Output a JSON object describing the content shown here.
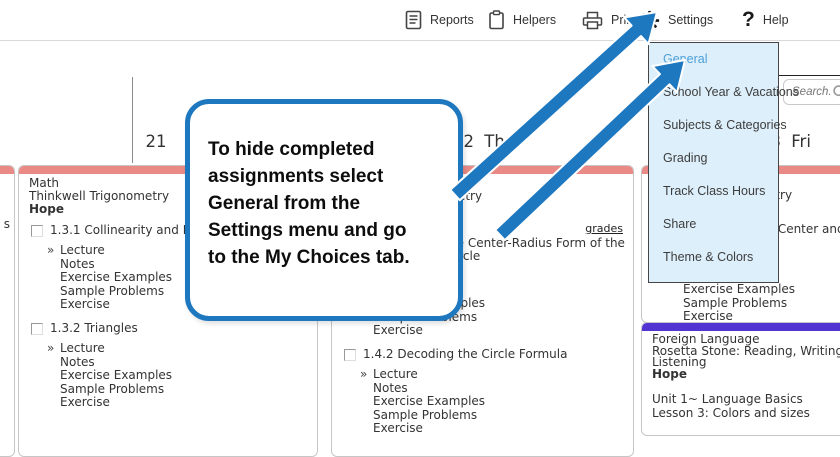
{
  "toolbar": {
    "items": [
      {
        "id": "reports",
        "label": "Reports",
        "icon": "reports-icon"
      },
      {
        "id": "helpers",
        "label": "Helpers",
        "icon": "helpers-icon"
      },
      {
        "id": "print",
        "label": "Print",
        "icon": "print-icon"
      },
      {
        "id": "settings",
        "label": "Settings",
        "icon": "settings-gear-icon"
      },
      {
        "id": "help",
        "label": "Help",
        "icon": "help-icon"
      }
    ]
  },
  "search": {
    "placeholder": "Search."
  },
  "settings_menu": {
    "items": [
      {
        "label": "General",
        "active": true
      },
      {
        "label": "School Year & Vacations",
        "active": false
      },
      {
        "label": "Subjects & Categories",
        "active": false
      },
      {
        "label": "Grading",
        "active": false
      },
      {
        "label": "Track Class Hours",
        "active": false
      },
      {
        "label": "Share",
        "active": false
      },
      {
        "label": "Theme & Colors",
        "active": false
      }
    ]
  },
  "callout": {
    "text": "To hide completed\nassignments select\nGeneral from the\nSettings menu and go\nto the My Choices tab."
  },
  "week": {
    "day_headers": [
      "21",
      "22 Thu",
      "23 Fri"
    ],
    "prev_day_fragment": "s"
  },
  "columns": {
    "day21": {
      "course_lines": [
        "Math",
        "Thinkwell Trigonometry"
      ],
      "student": "Hope",
      "sections": [
        {
          "title": "1.3.1 Collinearity and Distance",
          "items": [
            "Lecture",
            "Notes",
            "Exercise Examples",
            "Sample Problems",
            "Exercise"
          ]
        },
        {
          "title": "1.3.2 Triangles",
          "items": [
            "Lecture",
            "Notes",
            "Exercise Examples",
            "Sample Problems",
            "Exercise"
          ]
        }
      ]
    },
    "day22": {
      "course_lines": [
        "Math",
        "Thinkwell Trigonometry"
      ],
      "student": "Hope",
      "grades_link": "grades",
      "sections": [
        {
          "title": "1.4.1 Finding the Center-Radius Form of the Equation of a Circle",
          "items": [
            "Lecture",
            "Notes",
            "Exercise Examples",
            "Sample Problems",
            "Exercise"
          ]
        },
        {
          "title": "1.4.2 Decoding the Circle Formula",
          "items": [
            "Lecture",
            "Notes",
            "Exercise Examples",
            "Sample Problems",
            "Exercise"
          ]
        }
      ]
    },
    "day23": {
      "course_lines": [
        "Math",
        "Thinkwell Trigonometry"
      ],
      "student": "Hope",
      "sections": [
        {
          "title": "1.4.1 Finding the Center and Radius of a Circle",
          "items": [
            "Lecture",
            "Notes",
            "Exercise Examples",
            "Sample Problems",
            "Exercise"
          ]
        }
      ]
    },
    "day23_language": {
      "course_lines": [
        "Foreign Language",
        "Rosetta Stone: Reading, Writing, Listening"
      ],
      "student": "Hope",
      "lesson_lines": [
        "Unit 1~ Language Basics",
        "Lesson 3: Colors and sizes"
      ]
    }
  },
  "colors": {
    "accent_blue": "#1e78c0",
    "card_header_red": "#e98a87",
    "card_header_purple": "#5134d1",
    "menu_bg": "#ddeffb",
    "menu_active_text": "#4da0d8"
  }
}
